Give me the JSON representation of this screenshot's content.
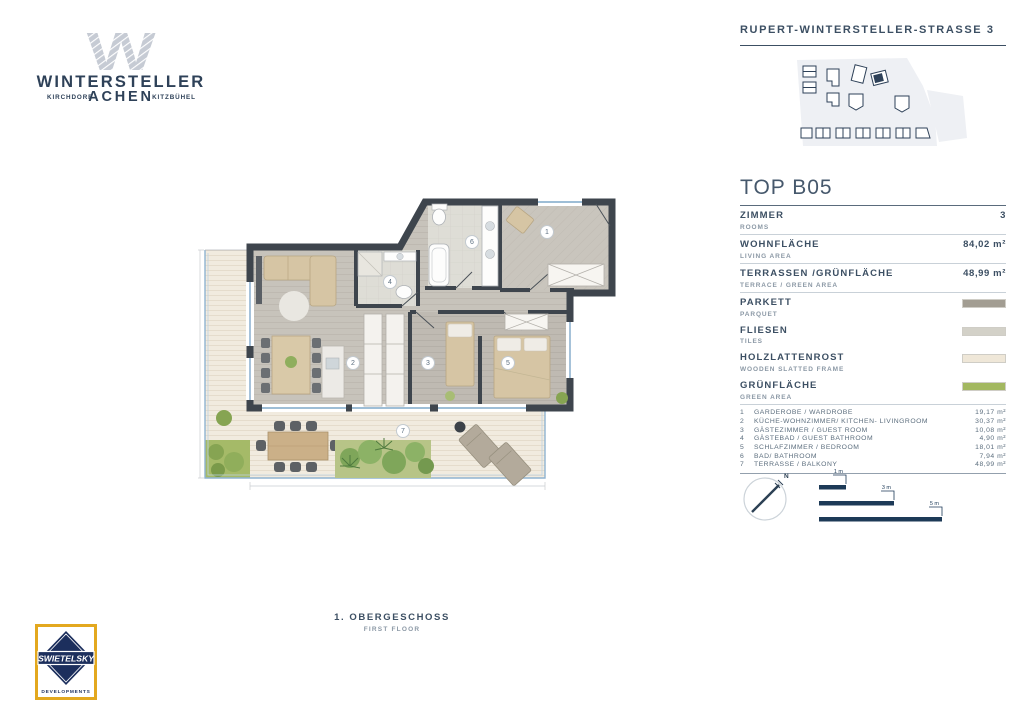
{
  "header": {
    "street": "RUPERT-WINTERSTELLER-STRASSE 3",
    "logo": {
      "mark": "W",
      "name": "WINTERSTELLER",
      "place_left": "KIRCHDORF",
      "place_center": "ACHEN",
      "place_right": "KITZBÜHEL"
    }
  },
  "unit": {
    "title": "TOP B05",
    "stats": [
      {
        "label": "ZIMMER",
        "sublabel": "ROOMS",
        "value": "3"
      },
      {
        "label": "WOHNFLÄCHE",
        "sublabel": "LIVING AREA",
        "value": "84,02 m²"
      },
      {
        "label": "TERRASSEN /GRÜNFLÄCHE",
        "sublabel": "TERRACE / GREEN AREA",
        "value": "48,99 m²"
      }
    ],
    "materials": [
      {
        "label": "PARKETT",
        "sublabel": "PARQUET",
        "color": "#a29d92"
      },
      {
        "label": "FLIESEN",
        "sublabel": "TILES",
        "color": "#d3d1c8"
      },
      {
        "label": "HOLZLATTENROST",
        "sublabel": "WOODEN SLATTED FRAME",
        "color": "#efe7d8"
      },
      {
        "label": "GRÜNFLÄCHE",
        "sublabel": "GREEN AREA",
        "color": "#a3b860"
      }
    ],
    "rooms": [
      {
        "no": "1",
        "name": "GARDEROBE / WARDROBE",
        "area": "19,17 m²"
      },
      {
        "no": "2",
        "name": "KÜCHE-WOHNZIMMER/ KITCHEN- LIVINGROOM",
        "area": "30,37 m²"
      },
      {
        "no": "3",
        "name": "GÄSTEZIMMER / GUEST ROOM",
        "area": "10,08 m²"
      },
      {
        "no": "4",
        "name": "GÄSTEBAD / GUEST BATHROOM",
        "area": "4,90 m²"
      },
      {
        "no": "5",
        "name": "SCHLAFZIMMER / BEDROOM",
        "area": "18,01 m²"
      },
      {
        "no": "6",
        "name": "BAD/ BATHROOM",
        "area": "7,94 m²"
      },
      {
        "no": "7",
        "name": "TERRASSE / BALKONY",
        "area": "48,99 m²"
      }
    ]
  },
  "scale": {
    "north": "N",
    "bars": [
      {
        "label": "1 m"
      },
      {
        "label": "3 m"
      },
      {
        "label": "5 m"
      }
    ]
  },
  "floor": {
    "title": "1. OBERGESCHOSS",
    "subtitle": "FIRST FLOOR"
  },
  "developer": {
    "name": "SWIETELSKY",
    "tagline": "DEVELOPMENTS"
  },
  "colors": {
    "navy": "#2e4158",
    "wall": "#3e454d",
    "parquet": "#c7c3bb",
    "tiles": "#dddbd4",
    "wood_deck": "#f1ebdf",
    "green": "#a3b860",
    "terrace_edge_blue": "#8fb3d1"
  }
}
